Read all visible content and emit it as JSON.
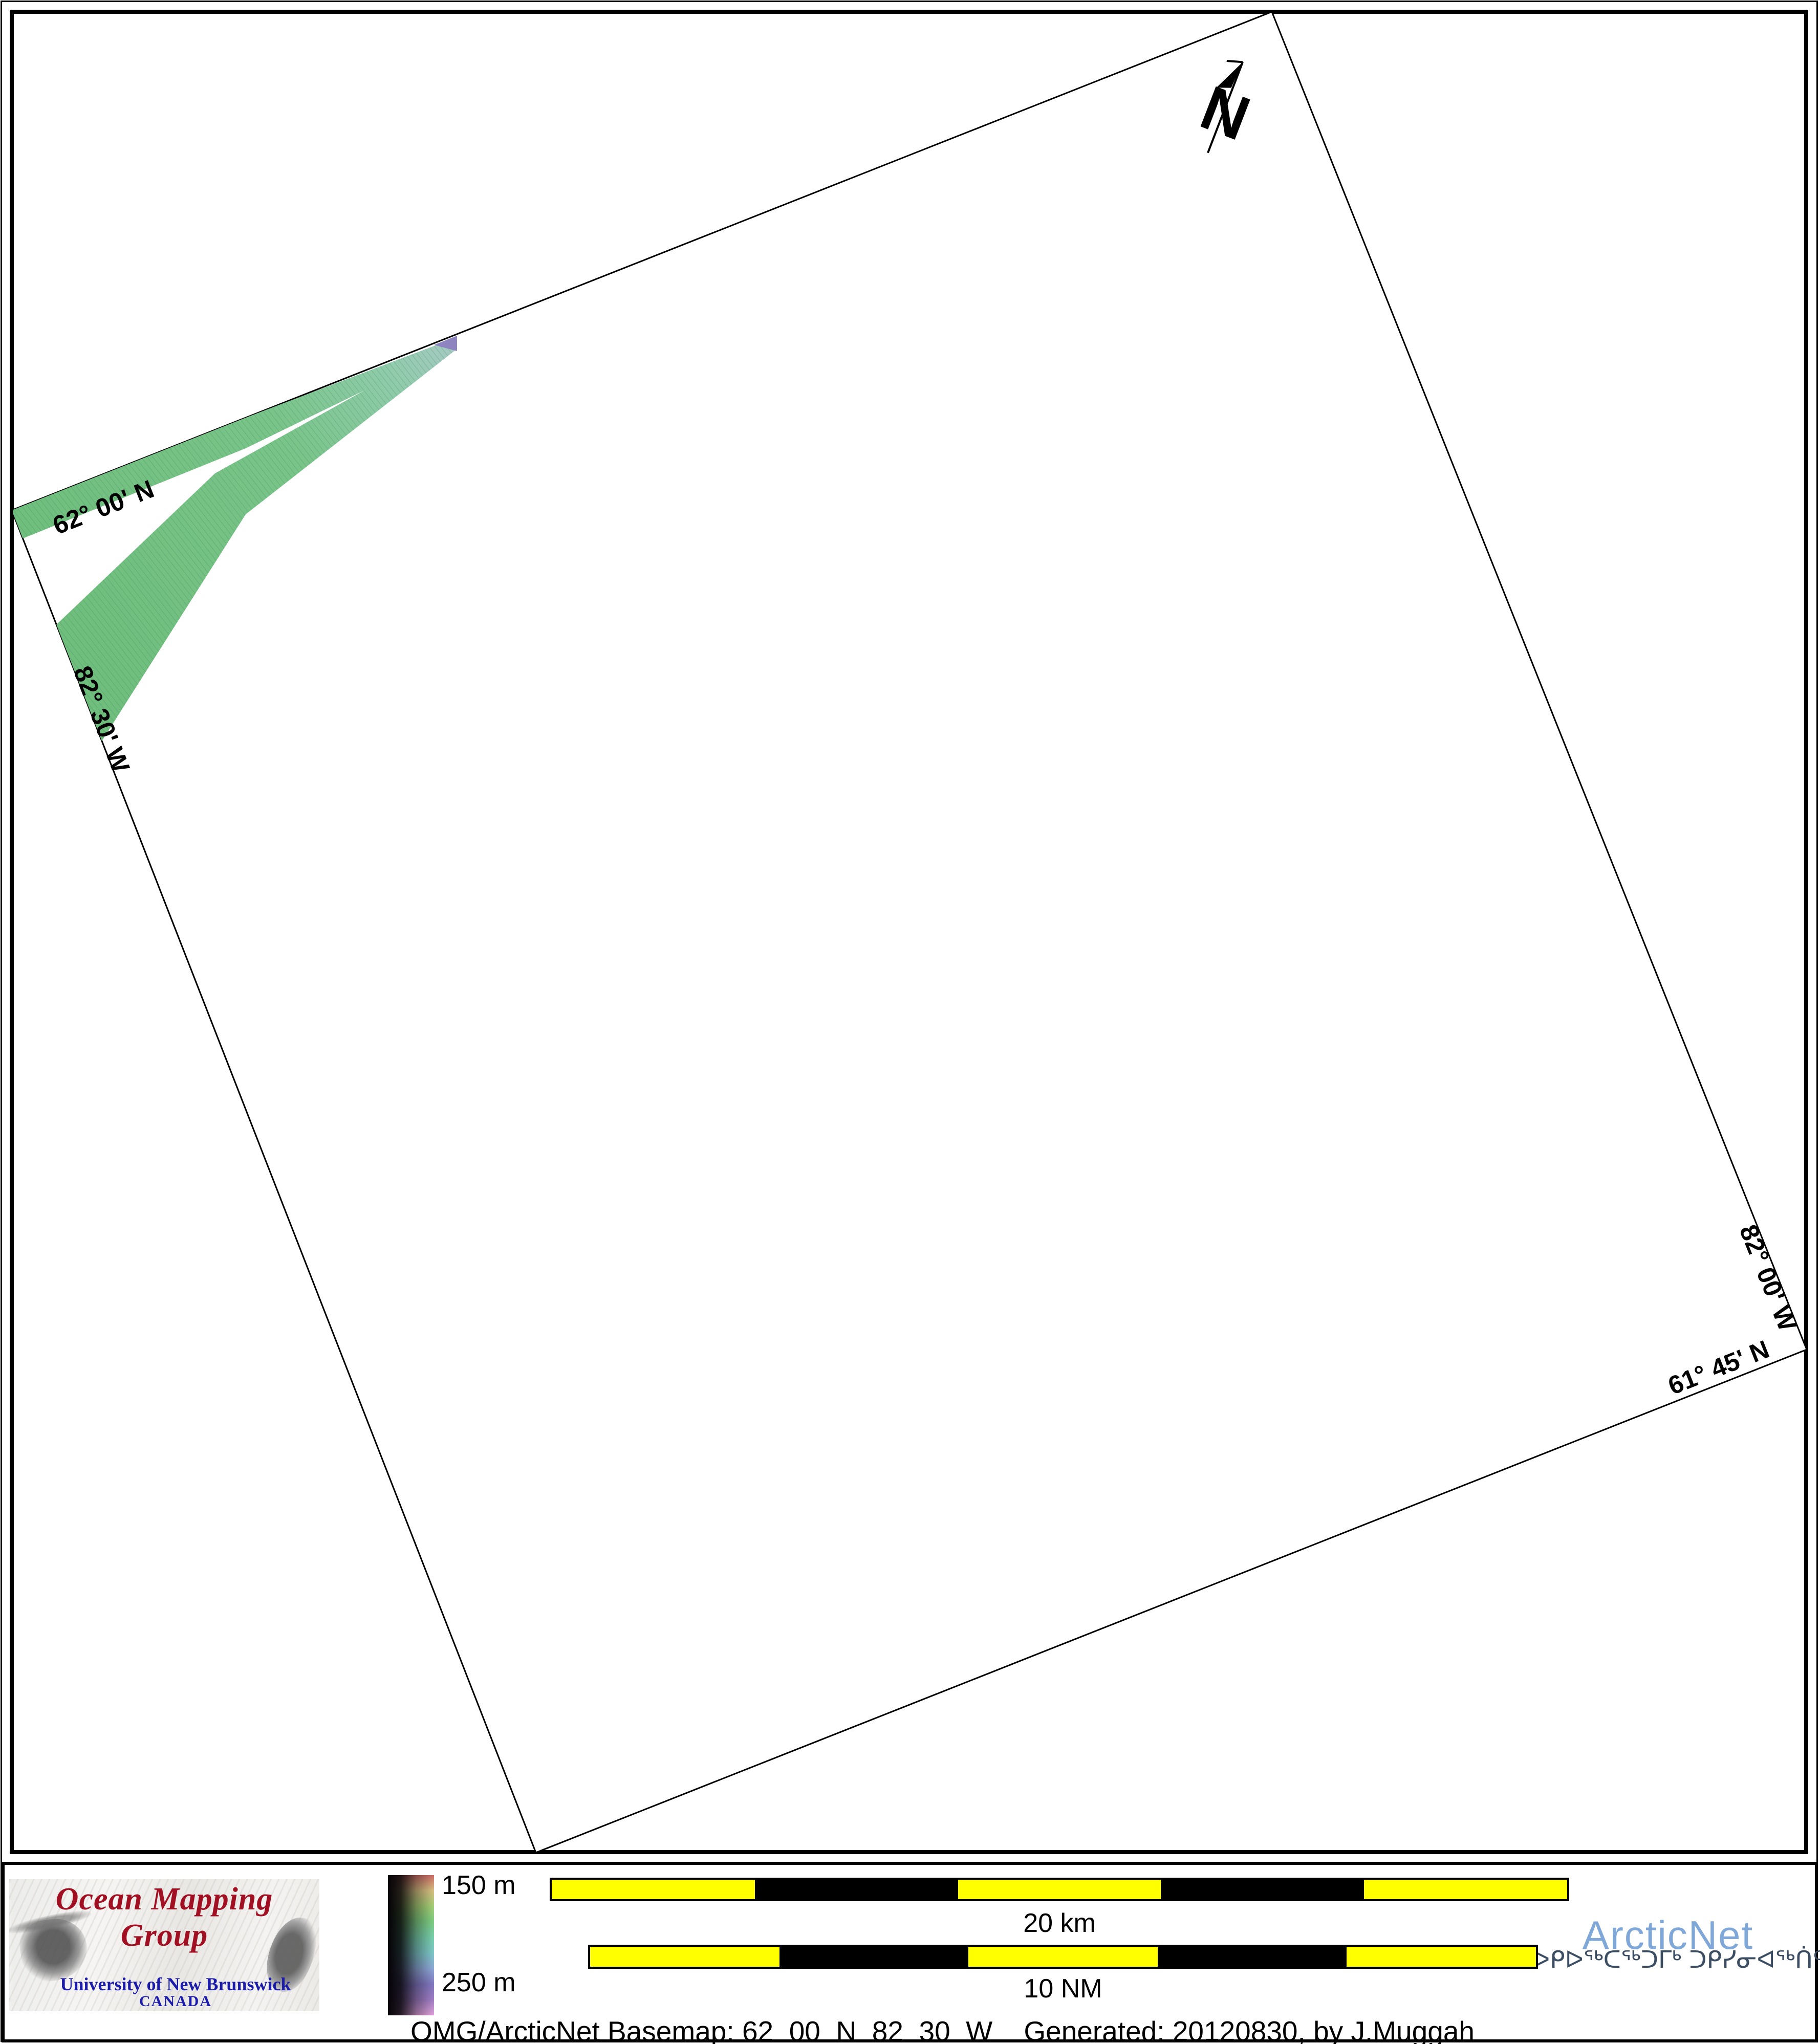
{
  "map": {
    "north_arrow_label": "N",
    "graticule_labels": {
      "top_left_lat": "62° 00' N",
      "left_lon": "82° 30' W",
      "right_lon": "82° 00' W",
      "bottom_right_lat": "61° 45' N"
    }
  },
  "legend": {
    "omg_logo": {
      "title": "Ocean Mapping Group",
      "institution": "University of New Brunswick",
      "country": "CANADA"
    },
    "depth_scale": {
      "min_label": "150 m",
      "max_label": "250 m",
      "colors_top_to_bottom": [
        "#cf6f68",
        "#d9c183",
        "#a8d176",
        "#7fd083",
        "#79d2ad",
        "#7fc9cc",
        "#8fa9da",
        "#8379c4",
        "#a37fc8",
        "#e2a3da"
      ]
    },
    "scale_bars": [
      {
        "id": "sb-20km",
        "label": "20 km",
        "segments": [
          "#ffff00",
          "#000000",
          "#ffff00",
          "#000000",
          "#ffff00"
        ]
      },
      {
        "id": "sb-10nm",
        "label": "10 NM",
        "segments": [
          "#ffff00",
          "#000000",
          "#ffff00",
          "#000000",
          "#ffff00"
        ]
      }
    ],
    "arcticnet_logo": {
      "name": "ArcticNet",
      "inuktitut": "ᐅᑭᐅᖅᑕᖅᑐᒥᒃ ᑐᑭᓯᓂᐊᖅᑏᑦ"
    },
    "caption": "OMG/ArcticNet Basemap: 62_00_N_82_30_W    Generated: 20120830, by J.Muggah"
  },
  "colors": {
    "arcticnet_blue": "#7fa8d9",
    "inuktitut_navy": "#3b4d63",
    "omg_red": "#a11022",
    "unb_blue": "#1c1caa",
    "scalebar_yellow": "#ffff00",
    "swath_green": "#6fbe7d",
    "swath_teal": "#a6c9c4",
    "swath_purple_tip": "#8d84c0"
  }
}
